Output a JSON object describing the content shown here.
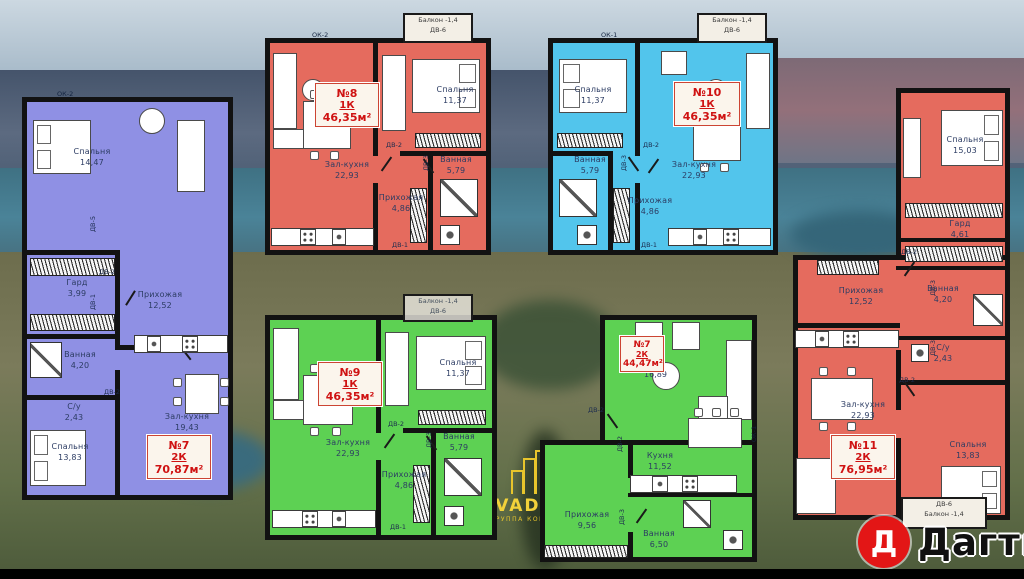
{
  "colors": {
    "plan_violet": "#8f90e4",
    "plan_red": "#e56b5e",
    "plan_blue": "#52c5ec",
    "plan_green": "#5dd153",
    "badge_text": "#cf1212",
    "logo_red": "#e31616",
    "watermark_yellow": "#e8c52c"
  },
  "plans": [
    {
      "id": "apartment-7-violet",
      "badge": {
        "number": "№7",
        "type": "2К",
        "area": "70,87м²"
      },
      "window_label": "ОК-2",
      "rooms": [
        {
          "name": "Спальня",
          "area": "14,47"
        },
        {
          "name": "Гард",
          "area": "3,99"
        },
        {
          "name": "Ванная",
          "area": "4,20"
        },
        {
          "name": "Прихожая",
          "area": "12,52"
        },
        {
          "name": "С/у",
          "area": "2,43"
        },
        {
          "name": "Зал-кухня",
          "area": "19,43"
        },
        {
          "name": "Спальня",
          "area": "13,83"
        }
      ],
      "doors": [
        "ДВ-5",
        "ДВ-2",
        "ДВ-1",
        "ДВ-2"
      ]
    },
    {
      "id": "apartment-8-red",
      "badge": {
        "number": "№8",
        "type": "1К",
        "area": "46,35м²"
      },
      "window_label": "ОК-2",
      "balcony": [
        "Балкон -1,4",
        "ДВ-6"
      ],
      "rooms": [
        {
          "name": "Спальня",
          "area": "11,37"
        },
        {
          "name": "Зал-кухня",
          "area": "22,93"
        },
        {
          "name": "Ванная",
          "area": "5,79"
        },
        {
          "name": "Прихожая",
          "area": "4,86"
        }
      ],
      "doors": [
        "ДВ-2",
        "ДВ-3",
        "ДВ-1"
      ]
    },
    {
      "id": "apartment-10-blue",
      "badge": {
        "number": "№10",
        "type": "1К",
        "area": "46,35м²"
      },
      "window_label": "ОК-1",
      "balcony": [
        "Балкон -1,4",
        "ДВ-6"
      ],
      "rooms": [
        {
          "name": "Спальня",
          "area": "11,37"
        },
        {
          "name": "Зал-кухня",
          "area": "22,93"
        },
        {
          "name": "Ванная",
          "area": "5,79"
        },
        {
          "name": "Прихожая",
          "area": "4,86"
        }
      ],
      "doors": [
        "ДВ-2",
        "ДВ-3",
        "ДВ-1"
      ]
    },
    {
      "id": "apartment-11-red",
      "badge": {
        "number": "№11",
        "type": "2К",
        "area": "76,95м²"
      },
      "balcony": [
        "ДВ-6",
        "Балкон -1,4"
      ],
      "rooms": [
        {
          "name": "Спальня",
          "area": "15,03"
        },
        {
          "name": "Гард",
          "area": "4,61"
        },
        {
          "name": "Ванная",
          "area": "4,20"
        },
        {
          "name": "С/у",
          "area": "2,43"
        },
        {
          "name": "Прихожая",
          "area": "12,52"
        },
        {
          "name": "Зал-кухня",
          "area": "22,93"
        },
        {
          "name": "Спальня",
          "area": "13,83"
        }
      ],
      "doors": [
        "ДВ-2",
        "ДВ-3",
        "ДВ-3",
        "ДВ-2"
      ]
    },
    {
      "id": "apartment-9-green",
      "badge": {
        "number": "№9",
        "type": "1К",
        "area": "46,35м²"
      },
      "balcony": [
        "Балкон -1,4",
        "ДВ-6"
      ],
      "rooms": [
        {
          "name": "Спальня",
          "area": "11,37"
        },
        {
          "name": "Зал-кухня",
          "area": "22,93"
        },
        {
          "name": "Ванная",
          "area": "5,79"
        },
        {
          "name": "Прихожая",
          "area": "4,86"
        }
      ],
      "doors": [
        "ДВ-2",
        "ДВ-3",
        "ДВ-1"
      ]
    },
    {
      "id": "apartment-7-green",
      "badge": {
        "number": "№7",
        "type": "2К",
        "area": "44,47м²"
      },
      "window_label": "ОК-1",
      "rooms": [
        {
          "name": "",
          "area": "16,89"
        },
        {
          "name": "Кухня",
          "area": "11,52"
        },
        {
          "name": "Прихожая",
          "area": "9,56"
        },
        {
          "name": "Ванная",
          "area": "6,50"
        }
      ],
      "doors": [
        "ДВ-2",
        "ДВ-2",
        "ДВ-3"
      ]
    }
  ],
  "watermark": {
    "brand": "VADRA",
    "tagline_1": "ГРУППА",
    "tagline_2": "КОМПАНИЙ"
  },
  "logo": {
    "letter": "Д",
    "name": "Дагти"
  }
}
